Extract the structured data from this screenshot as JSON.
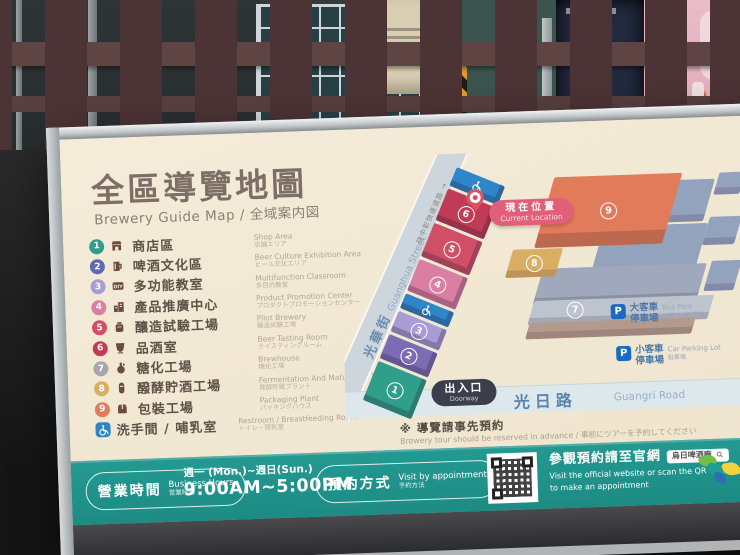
{
  "sign": {
    "title": "全區導覽地圖",
    "subtitle": "Brewery Guide Map / 全域案内図",
    "legend": [
      {
        "num": "1",
        "zh": "商店區",
        "en": "Shop Area",
        "ja": "店舗エリア",
        "color": "#2f9e8a"
      },
      {
        "num": "2",
        "zh": "啤酒文化區",
        "en": "Beer Culture Exhibition Area",
        "ja": "ビール文化エリア",
        "color": "#5f6ab2"
      },
      {
        "num": "3",
        "zh": "多功能教室",
        "en": "Multifunction Classroom",
        "ja": "多目的教室",
        "color": "#a89cd4"
      },
      {
        "num": "4",
        "zh": "產品推廣中心",
        "en": "Product Promotion Center",
        "ja": "プロダクトプロモーションセンター",
        "color": "#da7fa2"
      },
      {
        "num": "5",
        "zh": "釀造試驗工場",
        "en": "Pilot Brewery",
        "ja": "醸造試験工場",
        "color": "#d04f66"
      },
      {
        "num": "6",
        "zh": "品酒室",
        "en": "Beer Tasting Room",
        "ja": "テイスティングルーム",
        "color": "#c23b56"
      },
      {
        "num": "7",
        "zh": "糖化工場",
        "en": "Brewhouse",
        "ja": "糖化工場",
        "color": "#a9a4b0"
      },
      {
        "num": "8",
        "zh": "醱酵貯酒工場",
        "en": "Fermentation And Maturation Plant",
        "ja": "発酵貯蔵プラント",
        "color": "#d8ae62"
      },
      {
        "num": "9",
        "zh": "包裝工場",
        "en": "Packaging Plant",
        "ja": "パッキングハウス",
        "color": "#e27b5a"
      },
      {
        "num": "",
        "zh": "洗手間 / 哺乳室",
        "en": "Restroom / Breastfeeding Room",
        "ja": "トイレ・授乳室",
        "color": "#2e86c8"
      }
    ],
    "map": {
      "street_zh": "光華街",
      "street_en": "Guanghua Street",
      "direction": "往中彰快速道路 →",
      "current_zh": "現在位置",
      "current_en": "Current Location",
      "doorway_zh": "出入口",
      "doorway_en": "Doorway",
      "road_zh": "光日路",
      "road_en": "Guangri Road",
      "wuri_zh": "←往烏日區",
      "wuri_en": "To Wurih",
      "p_label": "P",
      "bus_zh1": "大客車",
      "bus_zh2": "停車場",
      "bus_en": "Bus Park",
      "bus_ja": "大型バス駐車場",
      "car_zh1": "小客車",
      "car_zh2": "停車場",
      "car_en": "Car Parking Lot",
      "car_ja": "駐車場",
      "other_building_color": "#93a2bd",
      "buildings": [
        {
          "num": "1",
          "color": "#2f9e8a"
        },
        {
          "num": "2",
          "color": "#7c6cb4"
        },
        {
          "num": "3",
          "color": "#a89cd4"
        },
        {
          "num": "4",
          "color": "#da7fa2"
        },
        {
          "num": "5",
          "color": "#d04f66"
        },
        {
          "num": "6",
          "color": "#c23b56"
        },
        {
          "num": "7",
          "color": "#a9a4b0"
        },
        {
          "num": "8",
          "color": "#d8ae62"
        },
        {
          "num": "9",
          "color": "#e27b5a"
        }
      ],
      "wheelchair_color": "#2e86c8"
    },
    "note_zh": "※ 導覽請事先預約",
    "note_en": "Brewery tour should be reserved in advance / 事前にツアーを予約してください",
    "footer": {
      "hours_zh": "營業時間",
      "hours_en": "Business Hours",
      "hours_ja": "営業時間",
      "days": "週一 (Mon.)~週日(Sun.)",
      "time": "9:00AM~5:00PM",
      "appt_zh": "預約方式",
      "appt_en": "Visit by appointment",
      "appt_ja": "予約方法",
      "web_zh": "參觀預約請至官網",
      "search_chip": "烏日啤酒廠",
      "web_en1": "Visit the official website or scan the QR CODE",
      "web_en2": "to make an appointment",
      "logo_text": "TTL"
    }
  }
}
